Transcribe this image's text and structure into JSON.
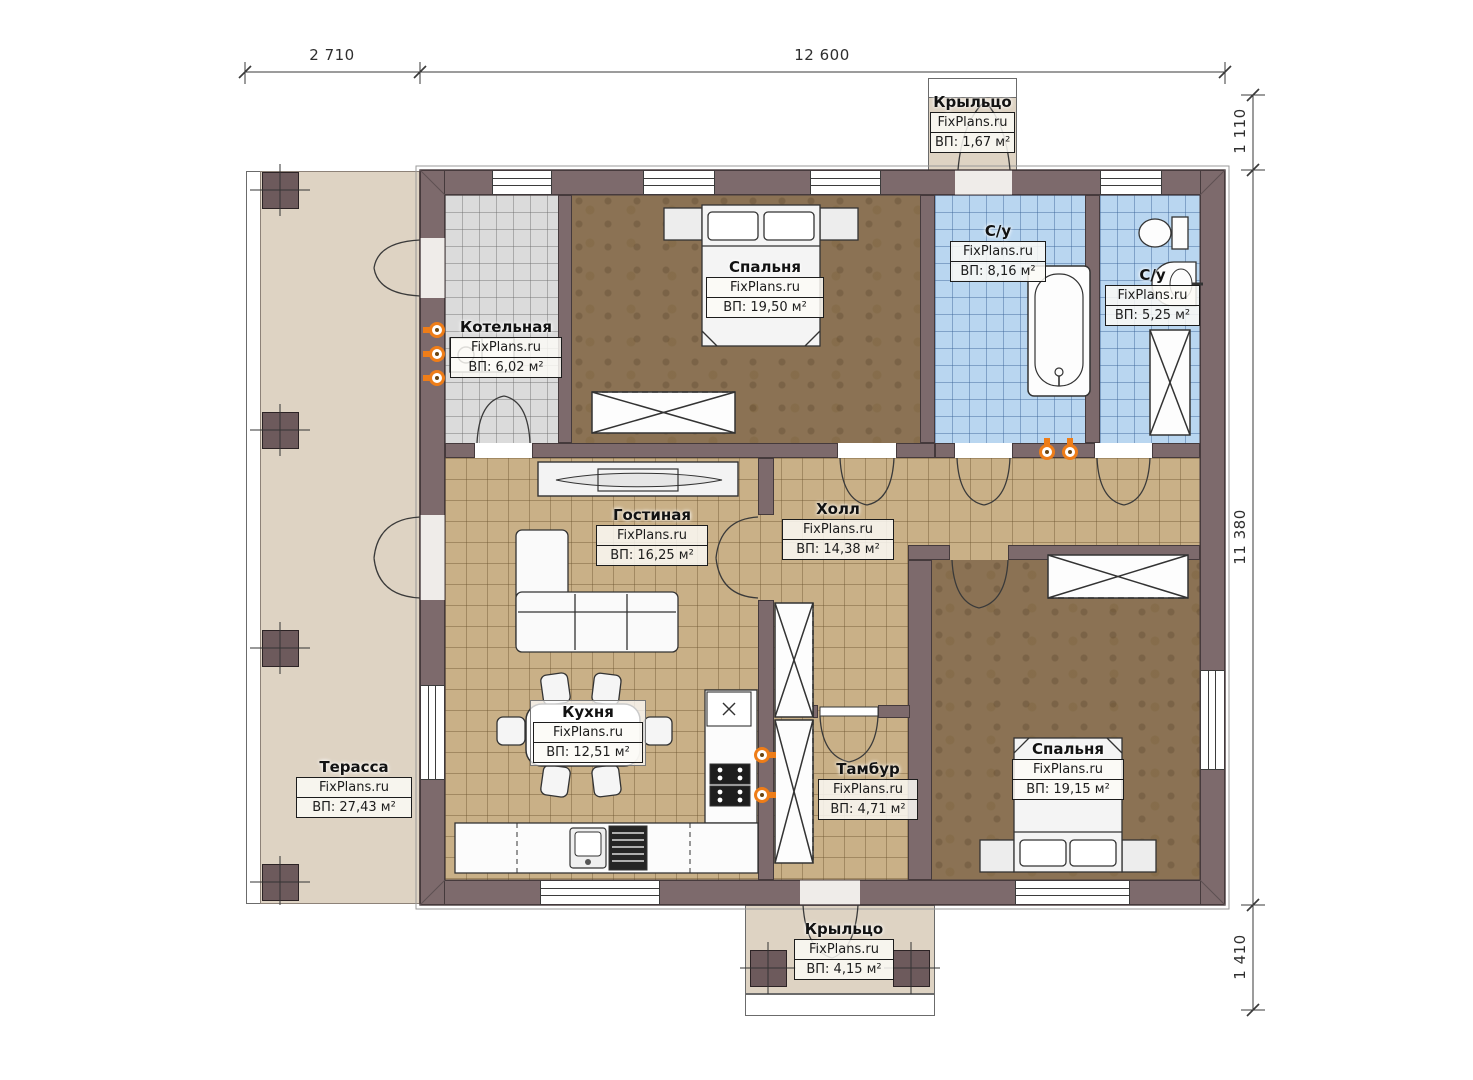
{
  "dims": {
    "top_left": "2 710",
    "top_right": "12 600",
    "right_top": "1 110",
    "right_mid": "11 380",
    "right_bottom": "1 410"
  },
  "rooms": {
    "porch_top": {
      "name": "Крыльцо",
      "brand": "FixPlans.ru",
      "area": "ВП: 1,67 м²"
    },
    "boiler": {
      "name": "Котельная",
      "brand": "FixPlans.ru",
      "area": "ВП: 6,02 м²"
    },
    "bedroom1": {
      "name": "Спальня",
      "brand": "FixPlans.ru",
      "area": "ВП: 19,50 м²"
    },
    "bath1": {
      "name": "С/у",
      "brand": "FixPlans.ru",
      "area": "ВП: 8,16 м²"
    },
    "bath2": {
      "name": "С/у",
      "brand": "FixPlans.ru",
      "area": "ВП: 5,25 м²"
    },
    "living": {
      "name": "Гостиная",
      "brand": "FixPlans.ru",
      "area": "ВП: 16,25 м²"
    },
    "hall": {
      "name": "Холл",
      "brand": "FixPlans.ru",
      "area": "ВП: 14,38 м²"
    },
    "kitchen": {
      "name": "Кухня",
      "brand": "FixPlans.ru",
      "area": "ВП: 12,51 м²"
    },
    "vestibule": {
      "name": "Тамбур",
      "brand": "FixPlans.ru",
      "area": "ВП: 4,71 м²"
    },
    "bedroom2": {
      "name": "Спальня",
      "brand": "FixPlans.ru",
      "area": "ВП: 19,15 м²"
    },
    "terrace": {
      "name": "Терасса",
      "brand": "FixPlans.ru",
      "area": "ВП: 27,43 м²"
    },
    "porch_bottom": {
      "name": "Крыльцо",
      "brand": "FixPlans.ru",
      "area": "ВП: 4,15 м²"
    }
  },
  "colors": {
    "wall": "#7d6a6c",
    "terrace_floor": "#ded3c3",
    "tile_tan": "#c9b087",
    "tile_blue": "#b9d6f0",
    "tile_gray": "#dbdbdb",
    "floor_brown": "#8b7254",
    "radiator_accent": "#ee7d18"
  }
}
